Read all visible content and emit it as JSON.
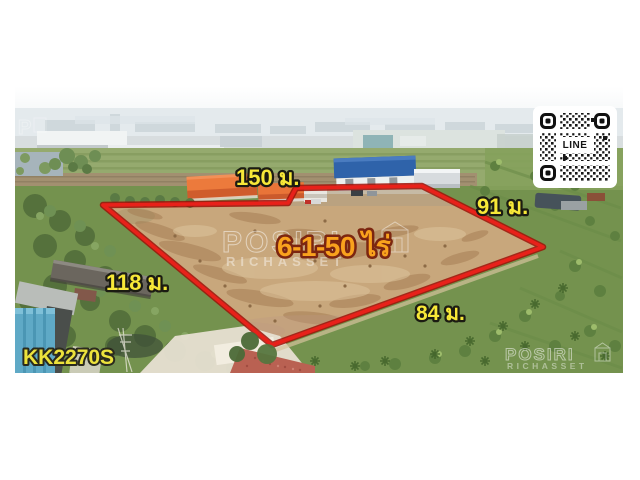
{
  "labels": {
    "side_top": "150 ม.",
    "side_right": "91 ม.",
    "side_left": "118 ม.",
    "side_bottom": "84 ม.",
    "area": "6-1-50 ไร่",
    "listing_code": "KK2270S"
  },
  "qr_code": {
    "service_label": "LINE"
  },
  "watermark": {
    "brand": "POSIRI",
    "sub": "RICHASSET",
    "corner_mark": "P"
  },
  "colors": {
    "boundary_red": "#e8211a",
    "boundary_edge": "#9e1208",
    "label_yellow": "#f7e838",
    "label_outline": "#1b1b12",
    "area_orange": "#f9a21d",
    "area_outline": "#7c2610",
    "code_yellow": "#ece23c",
    "code_outline": "#2a2a1e",
    "watermark_white": "#ffffff"
  }
}
